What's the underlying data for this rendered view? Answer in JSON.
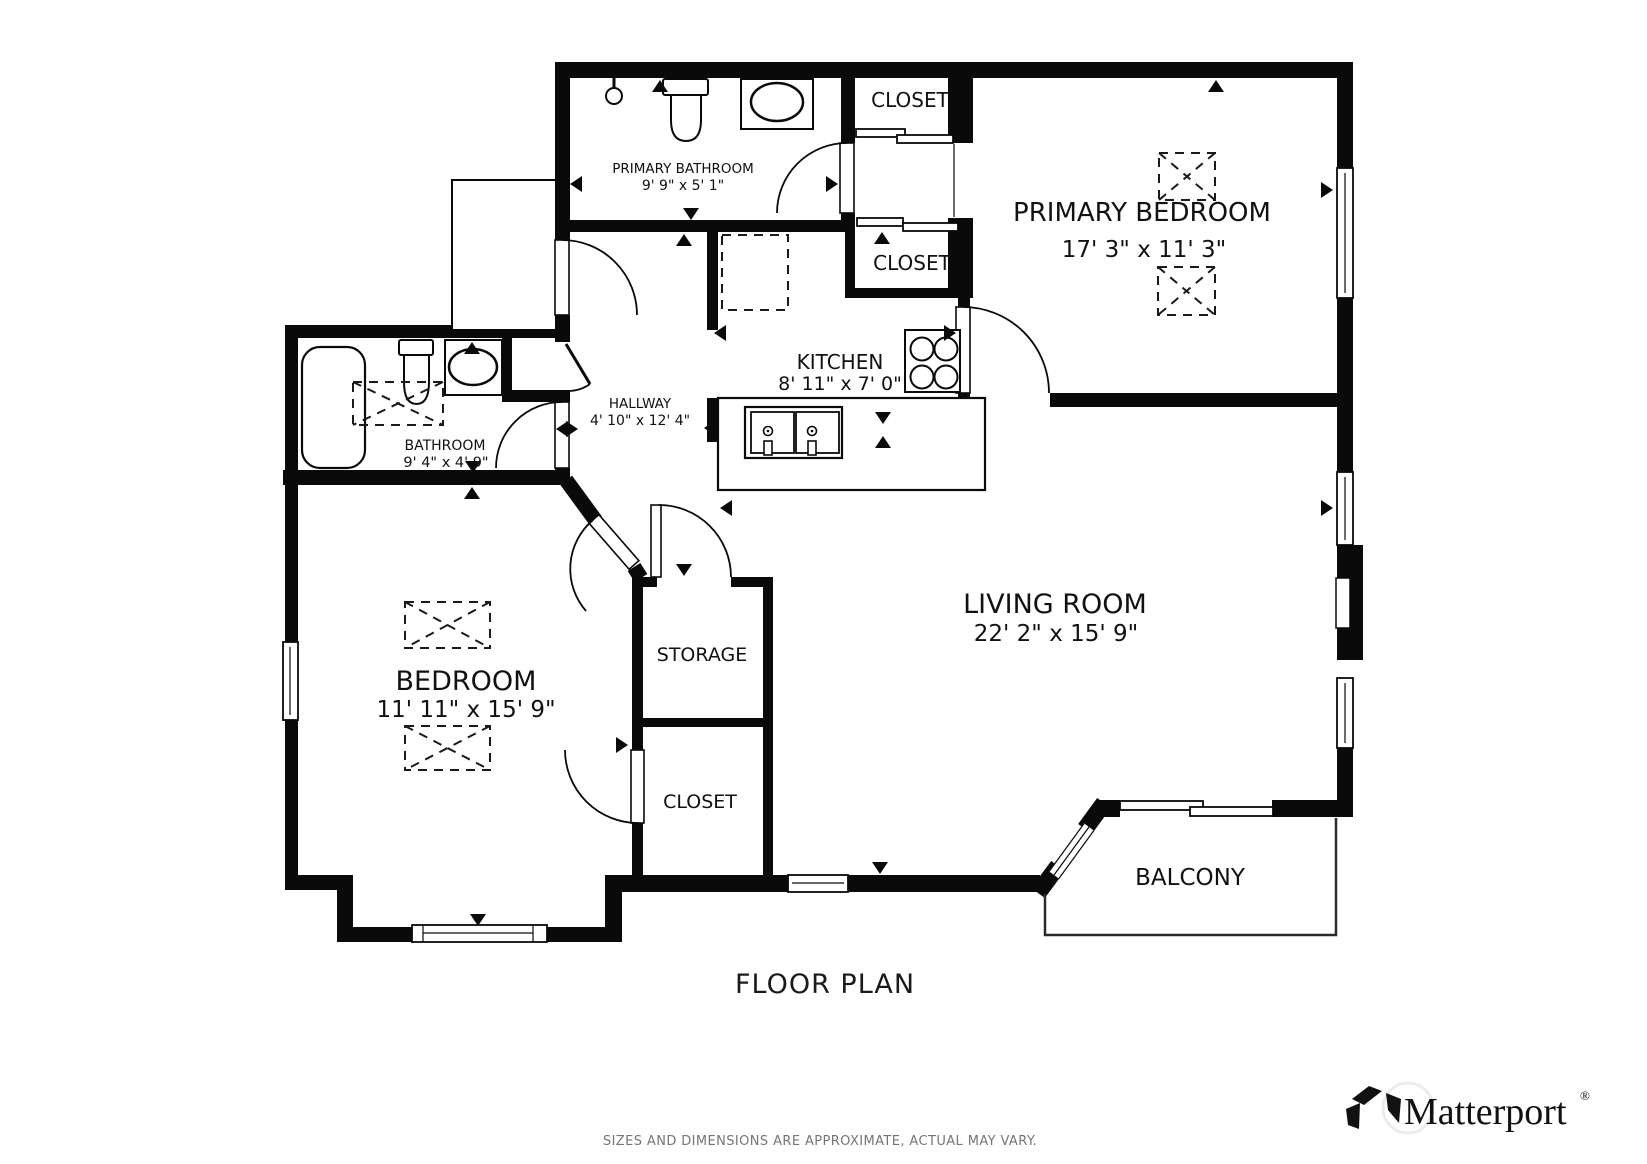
{
  "rooms": {
    "primary_bathroom": {
      "label": "PRIMARY BATHROOM",
      "dims": "9' 9\" x 5' 1\""
    },
    "closet_top": {
      "label": "CLOSET"
    },
    "primary_bedroom": {
      "label": "PRIMARY BEDROOM",
      "dims": "17' 3\" x 11' 3\""
    },
    "closet_mid": {
      "label": "CLOSET"
    },
    "kitchen": {
      "label": "KITCHEN",
      "dims": "8' 11\" x 7' 0\""
    },
    "hallway": {
      "label": "HALLWAY",
      "dims": "4' 10\" x 12' 4\""
    },
    "bathroom": {
      "label": "BATHROOM",
      "dims": "9' 4\" x 4' 9\""
    },
    "bedroom": {
      "label": "BEDROOM",
      "dims": "11' 11\" x 15' 9\""
    },
    "storage": {
      "label": "STORAGE"
    },
    "closet_lower": {
      "label": "CLOSET"
    },
    "living_room": {
      "label": "LIVING ROOM",
      "dims": "22' 2\" x 15' 9\""
    },
    "balcony": {
      "label": "BALCONY"
    }
  },
  "footer": {
    "title": "FLOOR PLAN",
    "disclaimer": "SIZES AND DIMENSIONS ARE APPROXIMATE, ACTUAL MAY VARY."
  },
  "brand": {
    "wordmark": "Matterport",
    "registered": "®"
  },
  "colors": {
    "walls": "#0a0a0a",
    "background": "#ffffff",
    "disclaimer_text": "#757575"
  },
  "fixtures": [
    "shower-icon",
    "toilet-icon",
    "vanity-sink-icon",
    "bathtub-icon",
    "stove-icon",
    "double-sink-icon",
    "sliding-door-icon",
    "window-icon",
    "door-swing-icon"
  ]
}
